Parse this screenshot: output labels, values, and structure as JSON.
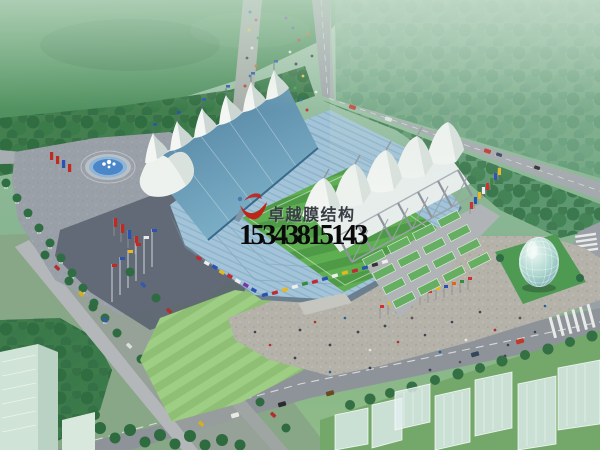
{
  "image": {
    "type": "architectural aerial rendering",
    "subject": "stadium with tensile membrane roof structures, plazas, roads and landscaping"
  },
  "watermark": {
    "company_name": "卓越膜结构",
    "phone_number": "15343815143",
    "logo": "red-swoosh-logo",
    "company_name_color": "#383d45",
    "phone_color": "#0a0a0a"
  },
  "scene": {
    "elements": [
      "west-grandstand-blue-roof",
      "white-membrane-tent-peaks",
      "football-pitch",
      "east-grandstand-white-membrane",
      "steel-support-masts",
      "green-rear-canopies",
      "circular-fountain",
      "red-flag-banners",
      "colorful-flag-rows",
      "egg-shaped-glass-building",
      "pedestrian-plaza",
      "tree-lined-parking-rows",
      "perimeter-roads",
      "translucent-city-buildings",
      "crowd-of-pedestrians",
      "cars"
    ],
    "palette": {
      "field_green": "#55945f",
      "tree_green": "#2f6b44",
      "roof_blue": "#5d8fae",
      "seats_blue": "#a3c4d8",
      "pitch_green_dark": "#4f9a47",
      "pitch_green_light": "#5fae52",
      "membrane_white": "#f2f4f1",
      "plaza_gray": "#b4b2a9",
      "road_gray": "#9aa0a6",
      "water_blue": "#4a86c8",
      "canopy_green": "#66ae62",
      "glass_teal": "#a9d4cc"
    }
  }
}
